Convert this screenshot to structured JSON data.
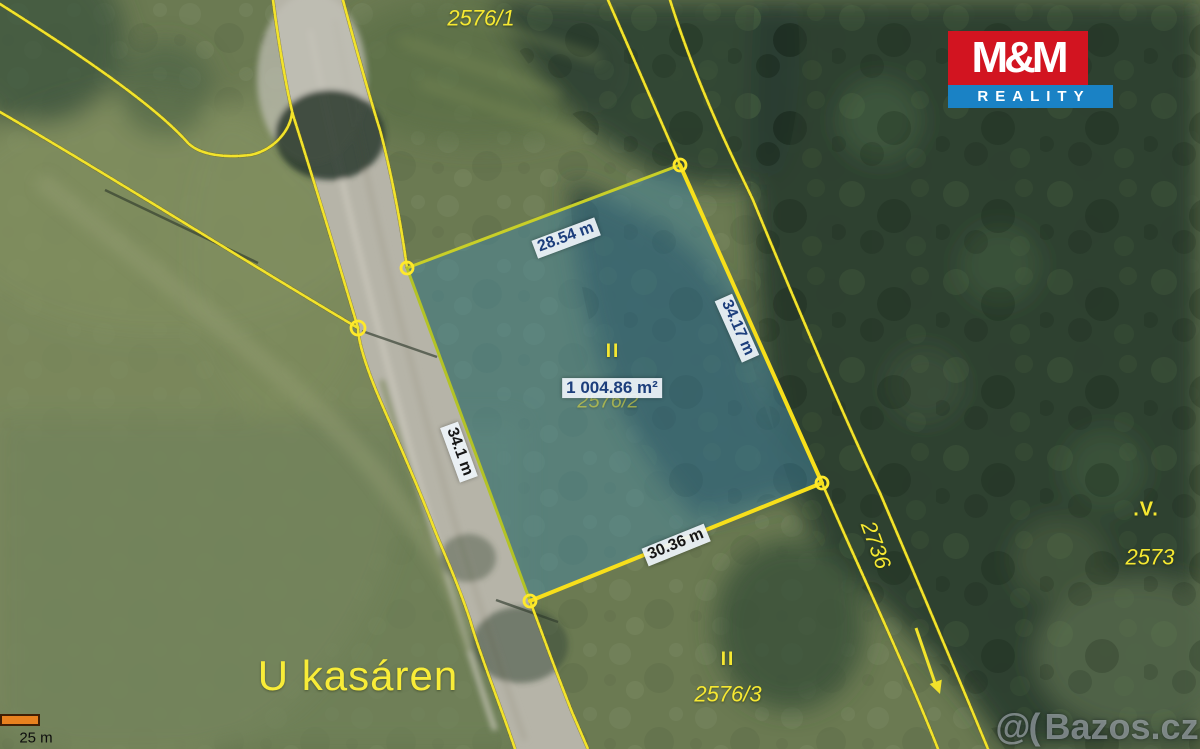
{
  "map": {
    "parcel_numbers": {
      "top": "2576/1",
      "road": "2736",
      "right": "2573",
      "bottom": "2576/3",
      "selected_ghost": "2576/2"
    },
    "markers": {
      "selected_parcel_culture": "II",
      "bottom_parcel_culture": "II",
      "right_parcel_symbol": ".V."
    },
    "street_label": "U kasáren",
    "measurements": {
      "top_edge": "28.54 m",
      "right_edge": "34.17 m",
      "left_edge": "34.1 m",
      "bottom_edge": "30.36 m",
      "area": "1 004.86 m²"
    },
    "scalebar": {
      "label": "25 m"
    }
  },
  "logo": {
    "title": "M&M",
    "subtitle": "REALITY"
  },
  "watermark": {
    "prefix": "@(",
    "domain": "Bazos.cz"
  },
  "colors": {
    "cadastral_yellow": "#f2e32b",
    "selection_fill": "rgba(70,135,165,0.48)",
    "measure_text_blue": "#1c3e7c",
    "logo_red": "#d21420",
    "logo_blue": "#1a82c5",
    "scalebar_orange": "#e8811f"
  }
}
